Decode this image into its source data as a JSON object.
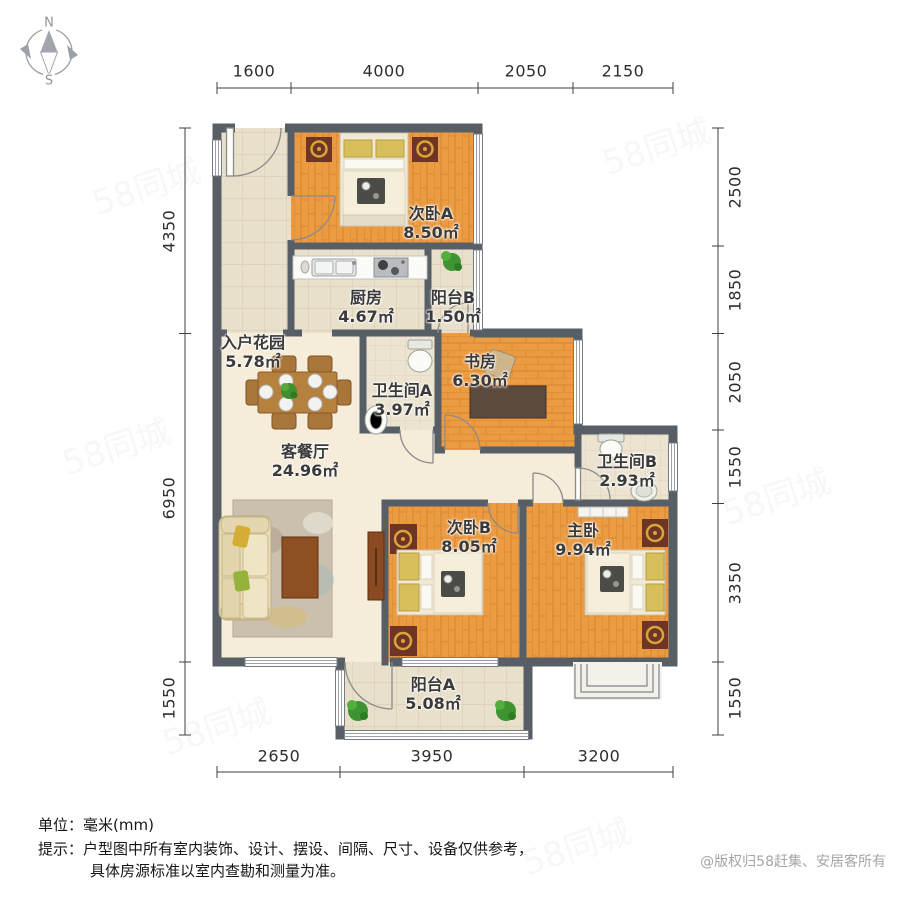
{
  "compass": {
    "north": "N",
    "south": "S"
  },
  "dimensions": {
    "top": [
      "1600",
      "4000",
      "2050",
      "2150"
    ],
    "bottom": [
      "2650",
      "3950",
      "3200"
    ],
    "left": [
      "4350",
      "6950",
      "1550"
    ],
    "right": [
      "2500",
      "1850",
      "2050",
      "1550",
      "3350",
      "1550"
    ]
  },
  "rooms": [
    {
      "name": "入户花园",
      "area": "5.78㎡"
    },
    {
      "name": "次卧A",
      "area": "8.50㎡"
    },
    {
      "name": "厨房",
      "area": "4.67㎡"
    },
    {
      "name": "阳台B",
      "area": "1.50㎡"
    },
    {
      "name": "卫生间A",
      "area": "3.97㎡"
    },
    {
      "name": "书房",
      "area": "6.30㎡"
    },
    {
      "name": "客餐厅",
      "area": "24.96㎡"
    },
    {
      "name": "卫生间B",
      "area": "2.93㎡"
    },
    {
      "name": "次卧B",
      "area": "8.05㎡"
    },
    {
      "name": "主卧",
      "area": "9.94㎡"
    },
    {
      "name": "阳台A",
      "area": "5.08㎡"
    }
  ],
  "footer": {
    "unit": "单位：毫米(mm)",
    "tip_line1": "提示：户型图中所有室内装饰、设计、摆设、间隔、尺寸、设备仅供参考，",
    "tip_line2": "具体房源标准以室内查勘和测量为准。",
    "copyright": "@版权归58赶集、安居客所有"
  },
  "watermark": {
    "text": "58同城"
  },
  "colors": {
    "wall": "#585e66",
    "wood_floor": "#eb9b41",
    "tile_floor": "#e8e0cb",
    "living_floor": "#f5ecda",
    "dining_wood": "#b5813f",
    "nightstand": "#6e3424",
    "lamp_gold": "#d9a43c",
    "plant_green": "#3d9430"
  }
}
